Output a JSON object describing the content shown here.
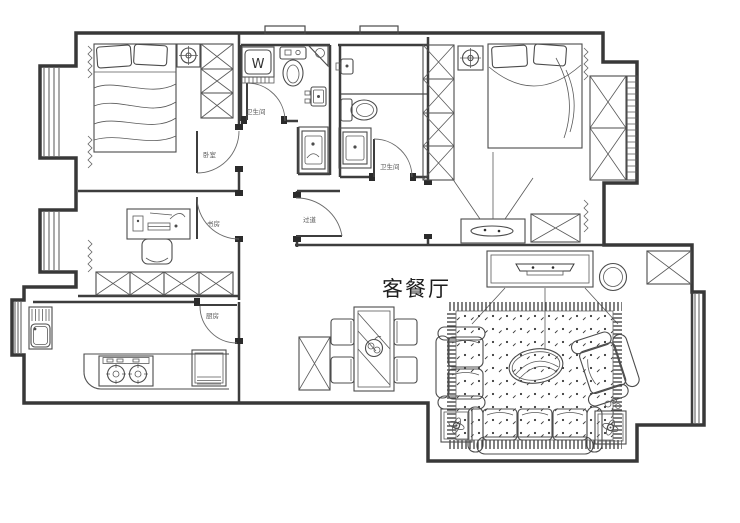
{
  "document": {
    "kind": "apartment floor plan drawing",
    "background": "#ffffff"
  },
  "colors": {
    "wall": "#383838",
    "furniture": "#4c4c4c",
    "main_label": "#1c1c1c",
    "tiny_label": "#5a5a5a"
  },
  "labels": {
    "living_dining": "客餐厅",
    "washing_machine": "W",
    "bedroom_door_tag": "卧室",
    "study_door_tag": "书房",
    "kitchen_door_tag": "厨房",
    "hallway_door_tag": "过道",
    "bathroom1_tag": "卫生间",
    "bathroom2_tag": "卫生间"
  },
  "furniture_icons": [
    "double-bed",
    "wardrobe-x-cells",
    "ceiling-fan",
    "desk-with-computer",
    "desk-chair",
    "low-cabinet-x-cells",
    "washing-machine",
    "toilet",
    "corner-shelf",
    "wall-basin",
    "vanity-sink",
    "shower-partition",
    "kitchen-sink",
    "gas-stove",
    "kitchen-appliance",
    "dining-table-with-fruit",
    "dining-chair",
    "sideboard",
    "tv-cabinet",
    "television",
    "round-stool",
    "corner-cabinet",
    "area-rug",
    "coffee-table",
    "loveseat",
    "armchair",
    "three-seat-sofa",
    "end-table-fan-lamp",
    "small-plant",
    "master-tv-stand",
    "window-bay"
  ]
}
